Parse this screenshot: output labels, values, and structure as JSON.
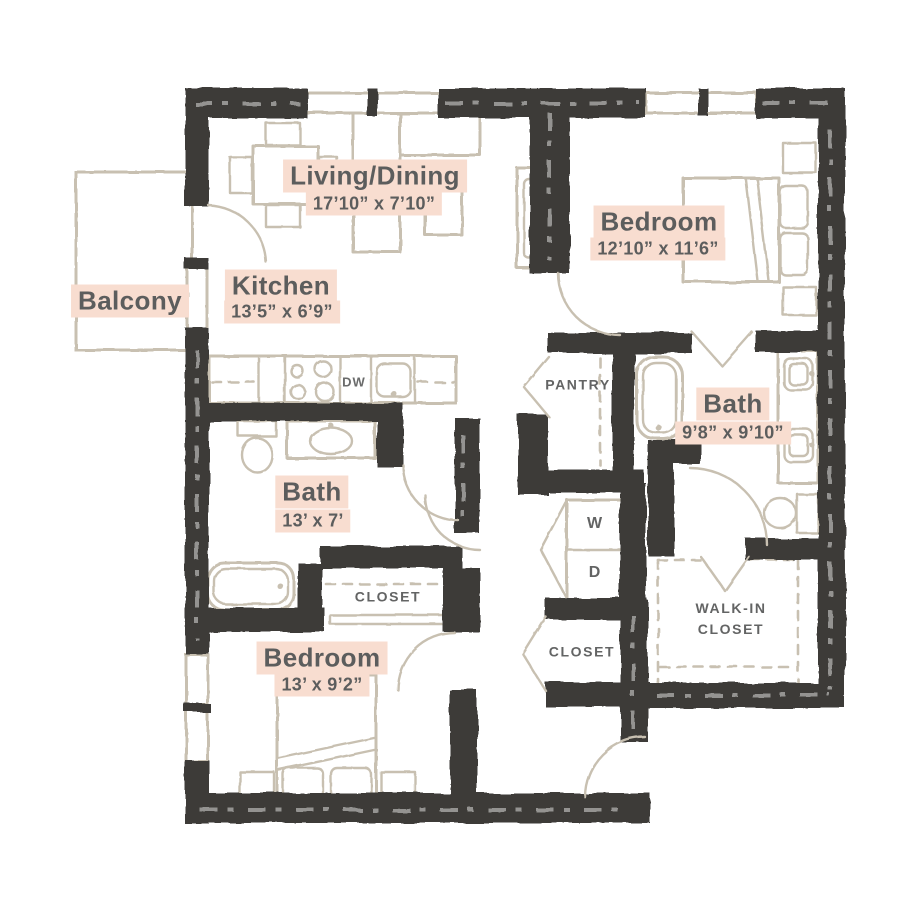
{
  "colors": {
    "wall": "#3d3b38",
    "fixture": "#c8c0b1",
    "highlight": "#f8ddd0",
    "label": "#5c5d5d",
    "label_small": "#636464",
    "background": "#ffffff"
  },
  "labels": {
    "living_dining": {
      "name": "Living/Dining",
      "dims": "17’10” x 7’10”"
    },
    "bedroom_top": {
      "name": "Bedroom",
      "dims": "12’10” x 11’6”"
    },
    "balcony": {
      "name": "Balcony"
    },
    "kitchen": {
      "name": "Kitchen",
      "dims": "13’5” x 6’9”"
    },
    "pantry": {
      "name": "PANTRY"
    },
    "bath_right": {
      "name": "Bath",
      "dims": "9’8” x 9’10”"
    },
    "bath_left": {
      "name": "Bath",
      "dims": "13’ x 7’"
    },
    "washer": {
      "name": "W"
    },
    "dryer": {
      "name": "D"
    },
    "closet_bath": {
      "name": "CLOSET"
    },
    "closet_hall": {
      "name": "CLOSET"
    },
    "walk_in_closet": {
      "line1": "WALK-IN",
      "line2": "CLOSET"
    },
    "bedroom_bottom": {
      "name": "Bedroom",
      "dims": "13’ x 9’2”"
    },
    "dishwasher": {
      "name": "DW"
    }
  }
}
